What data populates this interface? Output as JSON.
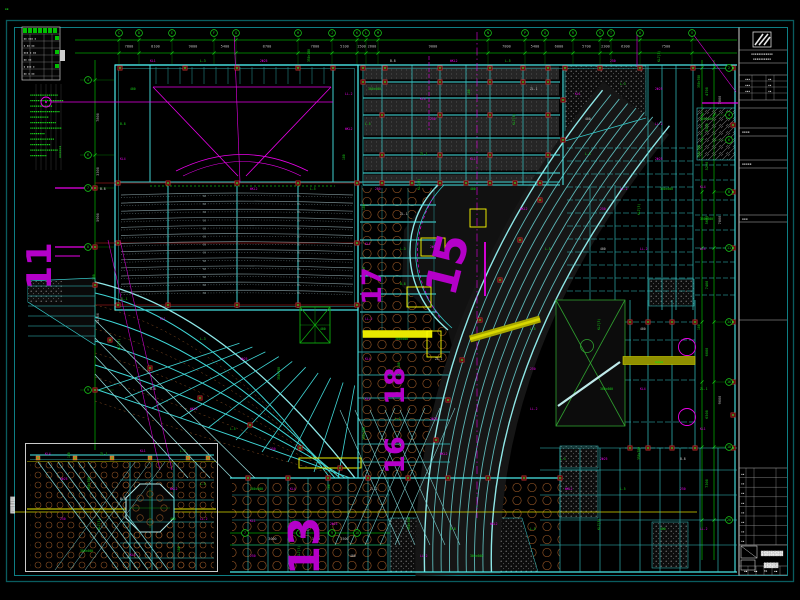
{
  "palette": {
    "background": "#000000",
    "cyan": "#35c8c8",
    "cyan_bright": "#8fe8e8",
    "green": "#19d219",
    "magenta": "#e800e8",
    "numeral_purple": "#b400c8",
    "dim_text": "#b9b9b9",
    "yellow": "#f2f200",
    "olive": "#9c9c00",
    "orange_hole": "#8a4f22",
    "red_marker": "#6e1010",
    "border_teal": "#0e7e84",
    "seat_gray": "#74888c"
  },
  "grid": {
    "top_bubbles": [
      "C",
      "D",
      "E",
      "F",
      "G",
      "H",
      "J",
      "K",
      "L",
      "M",
      "N",
      "P",
      "Q",
      "R",
      "S",
      "T",
      "U",
      "V"
    ],
    "left_bubbles": [
      "4",
      "6",
      "7",
      "8",
      "9"
    ],
    "right_bubbles": [
      "2",
      "4",
      "6",
      "8",
      "11",
      "14",
      "16",
      "18",
      "20"
    ],
    "bottom_bubbles": [
      "7",
      "8",
      "9",
      "10"
    ],
    "big_numerals": [
      {
        "t": "11",
        "x": 51,
        "y": 266,
        "r": -90,
        "s": 34
      },
      {
        "t": "13",
        "x": 319,
        "y": 546,
        "r": -90,
        "s": 42
      },
      {
        "t": "15",
        "x": 462,
        "y": 268,
        "r": -76,
        "s": 44
      },
      {
        "t": "17",
        "x": 381,
        "y": 286,
        "r": -90,
        "s": 27
      },
      {
        "t": "18",
        "x": 404,
        "y": 386,
        "r": -90,
        "s": 27
      },
      {
        "t": "16",
        "x": 404,
        "y": 455,
        "r": -90,
        "s": 27
      }
    ]
  },
  "dimensions": {
    "top": [
      "7800",
      "8100",
      "9000",
      "5400",
      "8700",
      "7800",
      "5100",
      "1500",
      "2600",
      "9000",
      "7800",
      "5400",
      "6000",
      "5700",
      "2300",
      "6300",
      "7500"
    ],
    "left": [
      "7800",
      "3300",
      "5900",
      "14300"
    ],
    "right": [
      "4700",
      "2500",
      "5200",
      "5600",
      "7400",
      "6000",
      "6500",
      "7300"
    ],
    "right_outer": [
      "7800",
      "7800",
      "9000"
    ],
    "bottom": [
      "3000",
      "1500",
      "2500"
    ]
  },
  "micro_labels": {
    "texts": [
      "KL1",
      "L-3",
      "2Φ25",
      "350×700",
      "B-8",
      "WKL2",
      "L-5",
      "250",
      "KL7(3)",
      "400",
      "LL-2",
      "300×600",
      "KL4",
      "180",
      "ZL-1"
    ]
  },
  "legend": {
    "rows": [
      "▪▪ ▪▪▪ ▪",
      "▪ ▪▪ ▪▪",
      "▪▪▪ ▪ ▪▪",
      "▪▪ ▪▪",
      "▪ ▪▪▪ ▪",
      "▪▪ ▪ ▪▪"
    ]
  },
  "notes": {
    "lines": [
      "▪▪▪▪▪▪▪▪▪▪▪▪▪▪▪",
      "▪▪▪▪▪▪▪▪▪▪▪▪▪▪▪▪▪▪",
      "▪▪▪▪▪▪▪▪▪▪▪▪",
      "▪▪▪▪▪▪▪▪▪▪▪▪▪▪▪▪",
      "▪▪▪▪▪▪▪▪▪▪",
      "▪▪▪▪▪▪▪▪▪▪▪▪▪▪",
      "▪▪▪▪▪▪▪▪▪▪▪▪▪▪▪▪▪",
      "▪▪▪▪▪▪▪▪",
      "▪▪▪▪▪▪▪▪▪▪▪▪▪",
      "▪▪▪▪▪▪▪▪▪▪▪",
      "▪▪▪▪▪▪▪▪▪▪▪▪▪▪▪",
      "▪▪▪▪▪▪▪▪▪"
    ]
  },
  "labels": {
    "detail_title_vertical": "▓▓▓▓▓▓▓",
    "section_label_vertical": "▪▪▪▪▪▪",
    "corner_marks": "▪▪",
    "olive_beam_tag": "▪▪▪▪",
    "yellow_beam_tag": "▪▪"
  },
  "title_block": {
    "firm_lines": [
      "▪▪▪▪▪▪▪▪▪▪▪▪",
      "▪▪▪▪▪▪▪▪▪▪"
    ],
    "approval_rows": [
      [
        "▪▪▪",
        "▪▪"
      ],
      [
        "▪▪▪",
        "▪▪"
      ],
      [
        "▪▪▪",
        "▪▪"
      ]
    ],
    "section_labels": [
      "▪▪▪▪",
      "▪▪▪▪▪",
      "▪▪▪"
    ],
    "revision_col": [
      "▪▪",
      "▪▪",
      "▪▪",
      "▪▪",
      "▪▪",
      "▪▪",
      "▪▪",
      "▪▪"
    ],
    "project_name": "▓▓▓▓▓▓▓▓",
    "drawing_name": "▓▓▓▓▓",
    "sheet_cells": [
      "▪▪",
      "▪▪",
      "01",
      "▪▪"
    ]
  }
}
